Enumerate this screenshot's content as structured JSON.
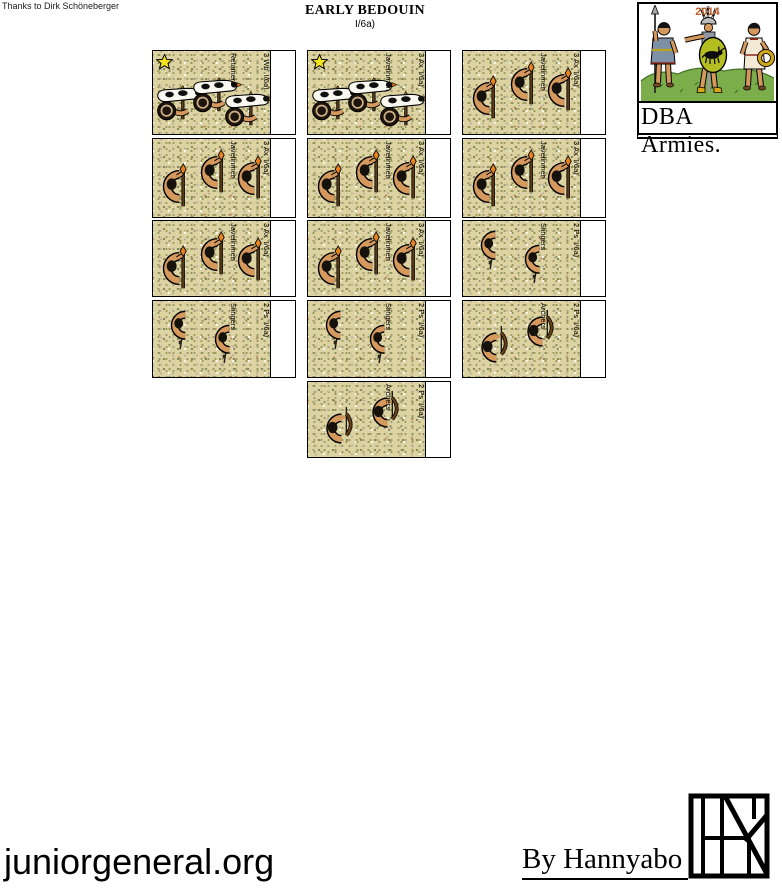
{
  "header": {
    "credit": "Thanks to Dirk Schöneberger",
    "title": "EARLY BEDOUIN",
    "subtitle": "I/6a)"
  },
  "brand": {
    "year": "2014",
    "caption": "DBA Armies."
  },
  "footer": {
    "site": "juniorgeneral.org",
    "author": "By Hannyabo"
  },
  "colors": {
    "sand": "#ddd3a2",
    "speckle_olive": "#8e9155",
    "year_text": "#bf5b28",
    "star_yellow": "#f4e31f",
    "skin": "#d6995d",
    "shield_green": "#b4be20",
    "grass_green": "#7bae4b",
    "weapon_tip_orange": "#e8831d"
  },
  "cards": [
    {
      "row": 0,
      "col": 0,
      "code": "3 Wb  I/6a)",
      "name": "Retainers",
      "type": "camel-riders",
      "figures": 3,
      "star": true
    },
    {
      "row": 0,
      "col": 1,
      "code": "3 Ax  I/6a)",
      "name": "Javelinmen",
      "type": "camel-riders",
      "figures": 3,
      "star": true
    },
    {
      "row": 0,
      "col": 2,
      "code": "3 Ax  I/6a)",
      "name": "Javelinmen",
      "type": "javelinmen",
      "figures": 3,
      "star": false
    },
    {
      "row": 1,
      "col": 0,
      "code": "3 Ax  I/6a)",
      "name": "Javelinmen",
      "type": "javelinmen",
      "figures": 3,
      "star": false
    },
    {
      "row": 1,
      "col": 1,
      "code": "3 Ax  I/6a)",
      "name": "Javelinmen",
      "type": "javelinmen",
      "figures": 3,
      "star": false
    },
    {
      "row": 1,
      "col": 2,
      "code": "3 Ax  I/6a)",
      "name": "Javelinmen",
      "type": "javelinmen",
      "figures": 3,
      "star": false
    },
    {
      "row": 2,
      "col": 0,
      "code": "3 Ax  I/6a)",
      "name": "Javelinmen",
      "type": "javelinmen",
      "figures": 3,
      "star": false
    },
    {
      "row": 2,
      "col": 1,
      "code": "3 Ax  I/6a)",
      "name": "Javelinmen",
      "type": "javelinmen",
      "figures": 3,
      "star": false
    },
    {
      "row": 2,
      "col": 2,
      "code": "2 Ps  I/6a)",
      "name": "Slingers",
      "type": "slingers",
      "figures": 2,
      "star": false
    },
    {
      "row": 3,
      "col": 0,
      "code": "2 Ps  I/6a)",
      "name": "Slingers",
      "type": "slingers",
      "figures": 2,
      "star": false
    },
    {
      "row": 3,
      "col": 1,
      "code": "2 Ps  I/6a)",
      "name": "Slingers",
      "type": "slingers",
      "figures": 2,
      "star": false
    },
    {
      "row": 3,
      "col": 2,
      "code": "2 Ps  I/6a)",
      "name": "Archers",
      "type": "archers",
      "figures": 2,
      "star": false
    },
    {
      "row": 4,
      "col": 1,
      "code": "2 Ps  I/6a)",
      "name": "Archers",
      "type": "archers",
      "figures": 2,
      "star": false
    }
  ]
}
